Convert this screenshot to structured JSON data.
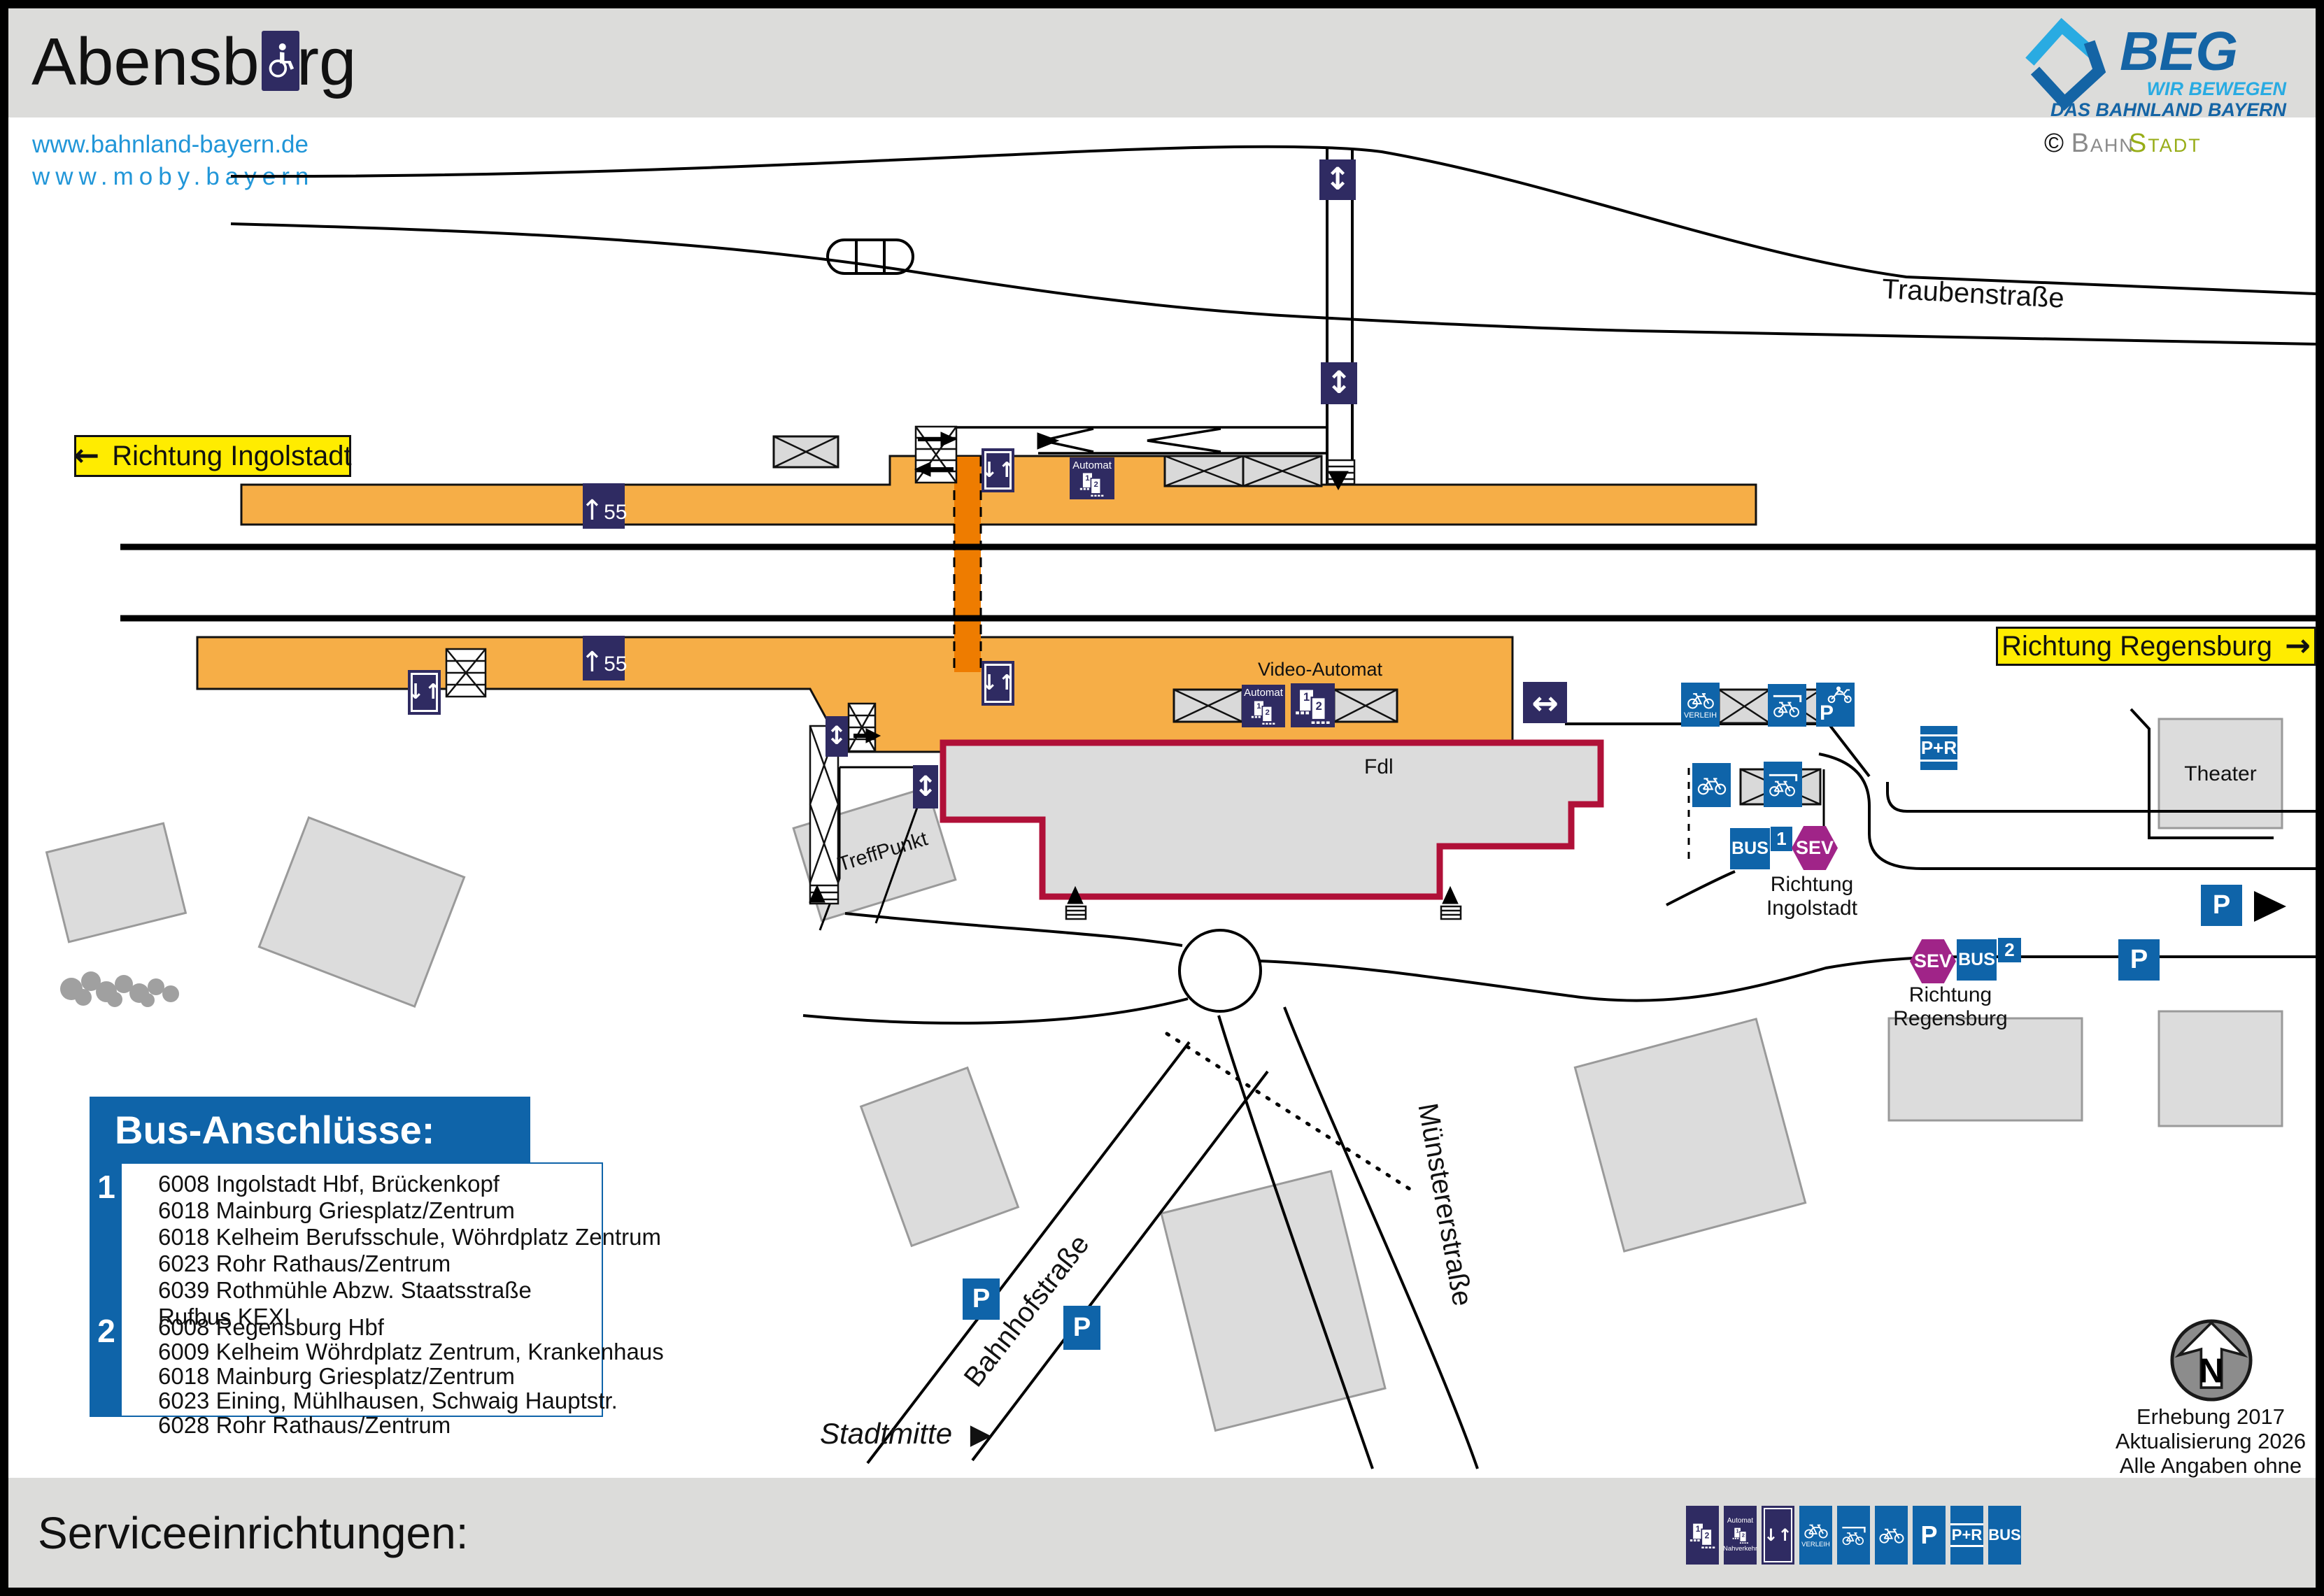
{
  "header": {
    "title": "Abensberg",
    "beg_name": "BEG",
    "beg_tagline1": "WIR BEWEGEN",
    "beg_tagline2": "DAS BAHNLAND BAYERN",
    "credit_symbol": "©",
    "credit_part1": "Bahn",
    "credit_part2": "Stadt"
  },
  "links": {
    "url1": "www.bahnland-bayern.de",
    "url2": "www.moby.bayern"
  },
  "directions": {
    "left_arrow": "←",
    "right_arrow": "→",
    "ingolstadt": "Richtung Ingolstadt",
    "regensburg": "Richtung Regensburg",
    "stadtmitte": "Stadtmitte",
    "stadtmitte_arrow": "▶"
  },
  "streets": {
    "traubenstrasse": "Traubenstraße",
    "bahnhofstrasse": "Bahnhofstraße",
    "muenstererstrasse": "Münstererstraße"
  },
  "platform": {
    "arrow": "↑",
    "height": "55"
  },
  "icons": {
    "p": "P",
    "pr": "P+R",
    "bus": "BUS",
    "sev": "SEV",
    "verleih": "VERLEIH",
    "automat": "Automat",
    "nahverkehr": "Nahverkehr",
    "lift": "↓↑",
    "updown": "↕",
    "leftright": "↔"
  },
  "labels": {
    "video_automat": "Video-Automat",
    "fdl": "Fdl",
    "treffpunkt": "TreffPunkt",
    "theater": "Theater"
  },
  "stops": {
    "stop1": {
      "number": "1",
      "line1": "Richtung",
      "line2": "Ingolstadt"
    },
    "stop2": {
      "number": "2",
      "line1": "Richtung",
      "line2": "Regensburg"
    }
  },
  "bus_connections": {
    "title": "Bus-Anschlüsse:",
    "stop1_number": "1",
    "stop1_lines": [
      "6008 Ingolstadt Hbf, Brückenkopf",
      "6018 Mainburg Griesplatz/Zentrum",
      "6018 Kelheim Berufsschule, Wöhrdplatz Zentrum",
      "6023 Rohr Rathaus/Zentrum",
      "6039 Rothmühle Abzw. Staatsstraße",
      "Rufbus KEXI"
    ],
    "stop2_number": "2",
    "stop2_lines": [
      "6008 Regensburg Hbf",
      "6009 Kelheim Wöhrdplatz Zentrum, Krankenhaus",
      "6018 Mainburg Griesplatz/Zentrum",
      "6023 Eining, Mühlhausen, Schwaig Hauptstr.",
      "6028 Rohr Rathaus/Zentrum"
    ]
  },
  "compass": {
    "n": "N"
  },
  "notes": {
    "line1": "Erhebung 2017",
    "line2": "Aktualisierung 2026",
    "line3": "Alle Angaben ohne Gewähr!"
  },
  "footer": {
    "title": "Serviceeinrichtungen:"
  },
  "colors": {
    "navy": "#2f2b62",
    "traffic_blue": "#0f64a9",
    "platform_orange": "#f6ae47",
    "underpass_orange": "#ee7c00",
    "label_yellow": "#ffec00",
    "sev_magenta": "#a02488",
    "fdl_border": "#b01038",
    "link_blue": "#2196d8",
    "beg_dark_blue": "#1464a5",
    "beg_light_blue": "#29abe2",
    "bahnstadt_green": "#97ad17"
  }
}
